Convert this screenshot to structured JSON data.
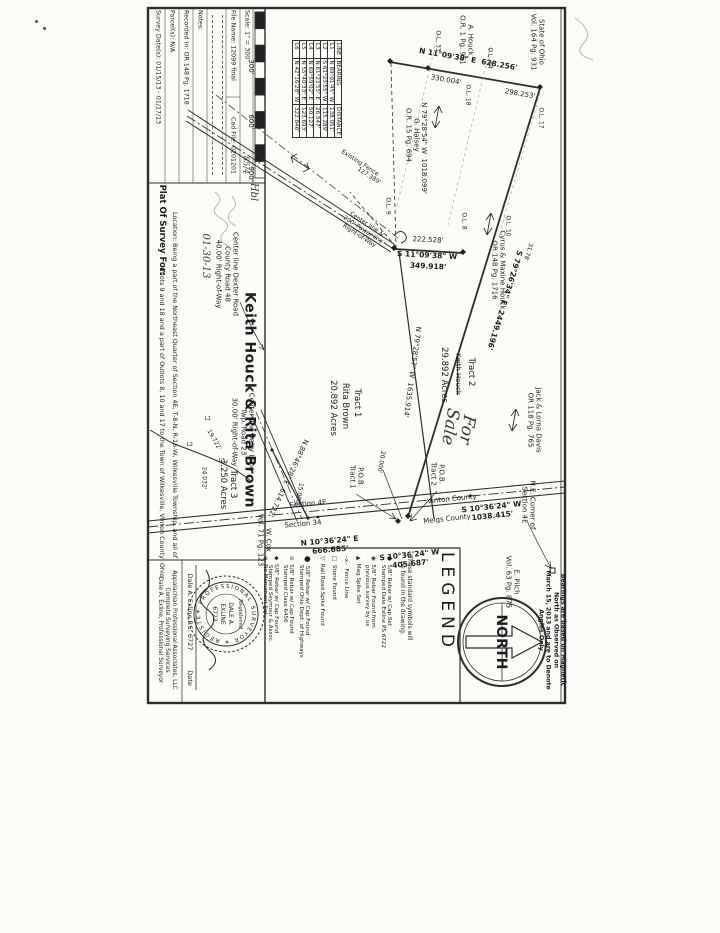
{
  "title_block": {
    "plat_of": "Plat Of Survey For:",
    "owner": "Keith Houck & Rita Brown",
    "location_line1": "Location: Being a part of the Northeast Quarter of Section 4E, T-8-N, R-16-W, Wilkesville Township, and all of",
    "location_line2": "Outlots 9 and 18 and a part of Outlots 8, 10 and 17 to the Town of Wilkesville, Vinton County, Ohio",
    "file_name": "File Name: 12099 final",
    "cad_file": "Cad File: 0201201",
    "scale": "Scale: 1\" = 300'",
    "scale_hand": "85/4",
    "survey_dates": "Survey Date(s): 01/15/13 - 01/17/13",
    "parcels": "Parcel(s): N/A",
    "recorded": "Recorded In: OR 148 Pg. 1718",
    "notes": "Notes:",
    "scale_ticks": [
      "300'",
      "600'",
      "900'"
    ]
  },
  "line_table": {
    "headers": [
      "LINE",
      "BEARING",
      "DISTANCE"
    ],
    "rows": [
      [
        "L1",
        "N 89°01'45\" W",
        "138.051'"
      ],
      [
        "L2",
        "S 61°23'55\" W",
        "115.289'"
      ],
      [
        "L3",
        "N 61°23'55\" E",
        "26.547'"
      ],
      [
        "L4",
        "N 69°59'02\" E",
        "50.127'"
      ],
      [
        "L5",
        "N 55°40'33\" E",
        "123.693'"
      ],
      [
        "L6",
        "N 42°16'28\" W",
        "322.846'"
      ]
    ]
  },
  "legend": {
    "title": "LEGEND",
    "note": [
      "These standard symbols will",
      "be found in the drawing."
    ],
    "items": [
      {
        "sym": "●",
        "x": 392,
        "lines": [
          "5/8\" Rebar w/ Cap Set",
          "Stamped Dale Exline PS 6722"
        ]
      },
      {
        "sym": "◉",
        "x": 376,
        "lines": [
          "5/8\" Rebar Found from",
          "previous survey by us"
        ]
      },
      {
        "sym": "▲",
        "x": 361,
        "lines": [
          "Mag Spike Set"
        ]
      },
      {
        "sym": "–x–",
        "x": 349,
        "lines": [
          "Fence Line"
        ]
      },
      {
        "sym": "□",
        "x": 337,
        "lines": [
          "Stone Found"
        ]
      },
      {
        "sym": "▽",
        "x": 325,
        "lines": [
          "Rail Road Spike Found"
        ]
      },
      {
        "sym": "⬤",
        "x": 310,
        "lines": [
          "5/8\" Rebar w/ Cap Found",
          "Stamped Ohio Dept. of Highways"
        ]
      },
      {
        "sym": "⊘",
        "x": 294,
        "lines": [
          "5/8\" Rebar w/ Cap Found",
          "Stamped Class 6456"
        ]
      },
      {
        "sym": "◆",
        "x": 279,
        "lines": [
          "5/8\" Rebar w/ Cap Found",
          "Stamped Seymour & Assoc."
        ]
      },
      {
        "sym": "⊕",
        "x": 268,
        "lines": [
          "No Monument Set"
        ]
      }
    ]
  },
  "north": {
    "label": "NORTH",
    "note": [
      "Bearings are based on Magnetic",
      "North as Observed on",
      "March 15, 2013 and are to Denote",
      "Angles Only"
    ]
  },
  "stamp": {
    "company": [
      "Appalachian Professional Associates, LLC",
      "Complete Surveying Services",
      "Dale A. Exline, Professional Surveyor"
    ],
    "signature_name": "Dale A. Exline P.S. 6727",
    "date_label": "Date",
    "seal_ring": "✶ PROFESSIONAL SURVEYOR ✶ REGISTERED",
    "seal_script": "Registered",
    "seal_line1": "DALE A.",
    "seal_line2": "EXLINE",
    "seal_line3": "6722"
  },
  "drawing": {
    "labels": [
      {
        "t": "N 11°09'38\" E  628.256'",
        "x": 468,
        "y": 60,
        "r": 10,
        "c": "b"
      },
      {
        "t": "330.004'",
        "x": 446,
        "y": 80,
        "r": 10
      },
      {
        "t": "298.253'",
        "x": 520,
        "y": 94,
        "r": 10
      },
      {
        "t": "State of Ohio\nVol. 164 Pg. 931",
        "x": 537,
        "y": 42,
        "r": 90
      },
      {
        "t": "A. Houck\nO.R. 1 Pg. 951",
        "x": 466,
        "y": 40,
        "r": 90
      },
      {
        "t": "O.L. 33",
        "x": 438,
        "y": 41,
        "r": 90,
        "c": "s"
      },
      {
        "t": "O.L. 34",
        "x": 490,
        "y": 58,
        "r": 90,
        "c": "s"
      },
      {
        "t": "O.L. 18",
        "x": 468,
        "y": 95,
        "r": 90,
        "c": "s"
      },
      {
        "t": "O.L. 17",
        "x": 541,
        "y": 118,
        "r": 90,
        "c": "s"
      },
      {
        "t": "O.L. 10",
        "x": 508,
        "y": 226,
        "r": 90,
        "c": "s"
      },
      {
        "t": "O.L. 9",
        "x": 388,
        "y": 206,
        "r": 90,
        "c": "s"
      },
      {
        "t": "O.L. 8",
        "x": 464,
        "y": 221,
        "r": 90,
        "c": "s"
      },
      {
        "t": "G. Halsey\nO.R. 15 Pg. 694",
        "x": 412,
        "y": 135,
        "r": 90
      },
      {
        "t": "S 79°26'34\" E  2449.196'",
        "x": 504,
        "y": 300,
        "r": 107,
        "c": "b"
      },
      {
        "t": "31.78'",
        "x": 528,
        "y": 252,
        "r": 107,
        "c": "s"
      },
      {
        "t": "Cyrus & Maxine Houck\nOR 148 Pg. 1716",
        "x": 498,
        "y": 270,
        "r": 90
      },
      {
        "t": "Jack & Lorna Davis\nOR 118 Pg. 765",
        "x": 534,
        "y": 420,
        "r": 90
      },
      {
        "t": "N 79°28'54\" W  1018.099'",
        "x": 424,
        "y": 148,
        "r": 90
      },
      {
        "t": "Existing Fence",
        "x": 360,
        "y": 163,
        "r": 33,
        "c": "s"
      },
      {
        "t": "127.389'",
        "x": 369,
        "y": 176,
        "r": 33,
        "c": "s"
      },
      {
        "t": "Center line &\n200' Power line\nRight-of-Way",
        "x": 363,
        "y": 230,
        "r": 33,
        "c": "s"
      },
      {
        "t": "222.528'",
        "x": 428,
        "y": 240,
        "r": 3
      },
      {
        "t": "S 11°09'38\" W",
        "x": 427,
        "y": 256,
        "r": 3,
        "c": "b"
      },
      {
        "t": "349.918'",
        "x": 428,
        "y": 267,
        "r": 3,
        "c": "b"
      },
      {
        "t": "Tract 2",
        "x": 471,
        "y": 372,
        "r": 90,
        "c": "m"
      },
      {
        "t": "Keith Houck",
        "x": 458,
        "y": 374,
        "r": 90,
        "c": "st"
      },
      {
        "t": "29.892 Acres",
        "x": 444,
        "y": 375,
        "r": 90,
        "c": "m"
      },
      {
        "t": "Tract 1",
        "x": 357,
        "y": 403,
        "r": 90,
        "c": "m"
      },
      {
        "t": "Rita Brown",
        "x": 345,
        "y": 406,
        "r": 90,
        "c": "m"
      },
      {
        "t": "20.892 Acres",
        "x": 333,
        "y": 408,
        "r": 90,
        "c": "m"
      },
      {
        "t": "N 79°28'57\" W  1635.914'",
        "x": 412,
        "y": 372,
        "r": 98
      },
      {
        "t": "For\nSale",
        "x": 458,
        "y": 428,
        "r": 100,
        "c": "h big"
      },
      {
        "t": "P.O.B.\nTract 1",
        "x": 356,
        "y": 477,
        "r": 90
      },
      {
        "t": "P.O.B.\nTract 2",
        "x": 437,
        "y": 474,
        "r": 90
      },
      {
        "t": "20.000'",
        "x": 381,
        "y": 462,
        "r": 100,
        "c": "s"
      },
      {
        "t": "15.000'",
        "x": 299,
        "y": 494,
        "r": 100,
        "c": "s"
      },
      {
        "t": "N 88°46'28\" E  614.722'",
        "x": 288,
        "y": 478,
        "r": 115
      },
      {
        "t": "Tract 3\n3.250 Acres",
        "x": 228,
        "y": 484,
        "r": 90,
        "c": "m"
      },
      {
        "t": "24.032'",
        "x": 204,
        "y": 478,
        "r": 90,
        "c": "s"
      },
      {
        "t": "19.722'",
        "x": 214,
        "y": 440,
        "r": 60,
        "c": "s"
      },
      {
        "t": "L1",
        "x": 208,
        "y": 420,
        "r": 0,
        "c": "t"
      },
      {
        "t": "L2",
        "x": 190,
        "y": 446,
        "r": 0,
        "c": "t"
      },
      {
        "t": "L3",
        "x": 222,
        "y": 462,
        "r": 0,
        "c": "t"
      },
      {
        "t": "Section 4E",
        "x": 308,
        "y": 504,
        "r": -5
      },
      {
        "t": "Section 34",
        "x": 303,
        "y": 524,
        "r": -5
      },
      {
        "t": "Vinton County",
        "x": 452,
        "y": 499,
        "r": -6
      },
      {
        "t": "Meigs County",
        "x": 447,
        "y": 519,
        "r": -6
      },
      {
        "t": "N 10°36'24\" E\n666.685'",
        "x": 330,
        "y": 546,
        "r": -5,
        "c": "b"
      },
      {
        "t": "S 10°36'24\" W\n1038.415'",
        "x": 492,
        "y": 512,
        "r": -6,
        "c": "b"
      },
      {
        "t": "S 10°36'24\" W\n405.687'",
        "x": 410,
        "y": 560,
        "r": -6,
        "c": "b"
      },
      {
        "t": "W. Cox\nVol. 71 Pg. 123",
        "x": 264,
        "y": 540,
        "r": 90
      },
      {
        "t": "N.E. Corner of\nSection 4E",
        "x": 528,
        "y": 505,
        "r": 90
      },
      {
        "t": "E. Pilch\nVol. 63 Pg. 875",
        "x": 512,
        "y": 582,
        "r": 90
      },
      {
        "t": "Center line Dexter Road\nCounty Road 48\n40.00' Right-of-Way",
        "x": 227,
        "y": 274,
        "r": 90
      },
      {
        "t": "Center line Dairy Lane\nTwp. Road 23\n30.00' Right-of-Way",
        "x": 243,
        "y": 432,
        "r": 90
      },
      {
        "t": "01-30-13",
        "x": 205,
        "y": 256,
        "r": 90,
        "c": "h"
      },
      {
        "t": "Hbl",
        "x": 253,
        "y": 192,
        "r": 90,
        "c": "h"
      }
    ]
  }
}
